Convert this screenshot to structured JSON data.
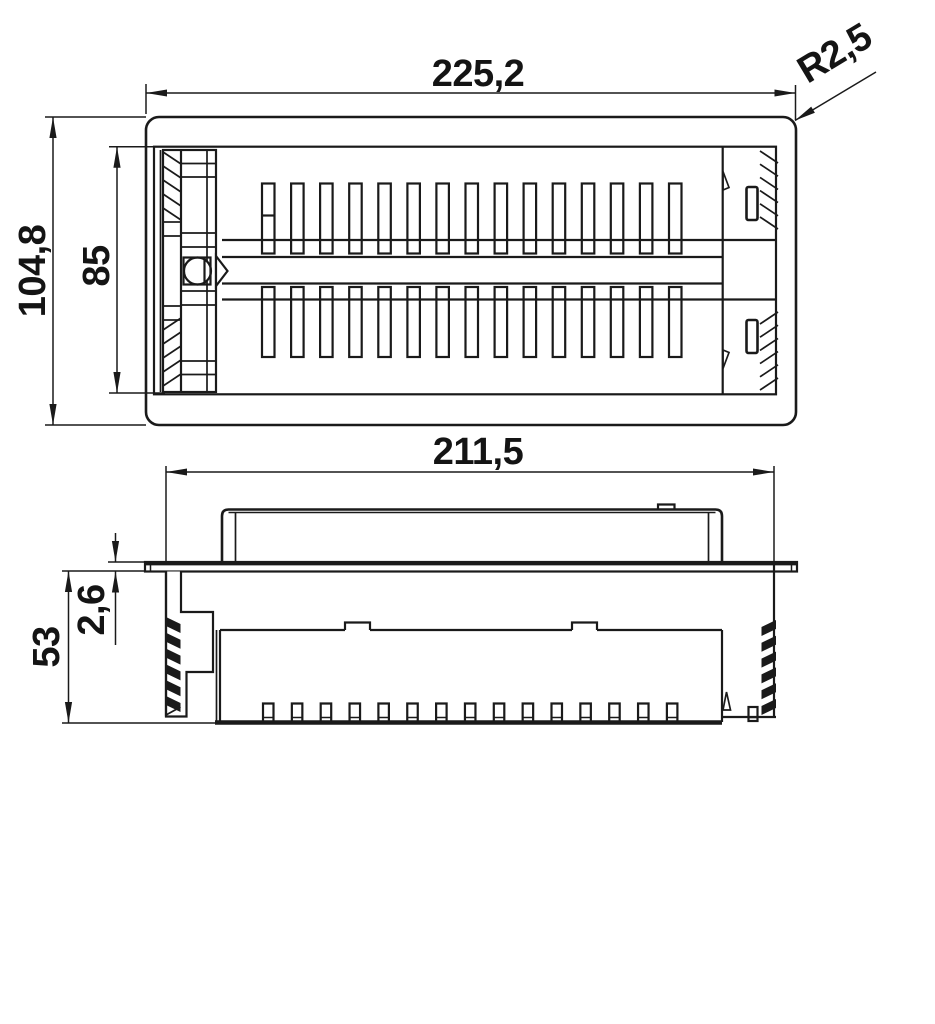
{
  "page": {
    "background_color": "#ffffff",
    "line_color": "#1a1a1a",
    "drawing_type": "2-view dimensioned technical drawing of vented panel with mounting clips"
  },
  "dims": {
    "overall_width": {
      "value": "225,2"
    },
    "corner_radius": {
      "value": "R2,5"
    },
    "overall_depth": {
      "value": "104,8"
    },
    "opening_depth": {
      "value": "85"
    },
    "body_width": {
      "value": "211,5"
    },
    "body_height": {
      "value": "53"
    },
    "flange_thickness": {
      "value": "2,6"
    }
  },
  "pattern": {
    "slots_per_row": 15,
    "slot_rows": 2,
    "feet_count": 15,
    "serration_teeth": 6,
    "latch_hatch_lines": 5,
    "corner_hatch_lines": 6
  }
}
